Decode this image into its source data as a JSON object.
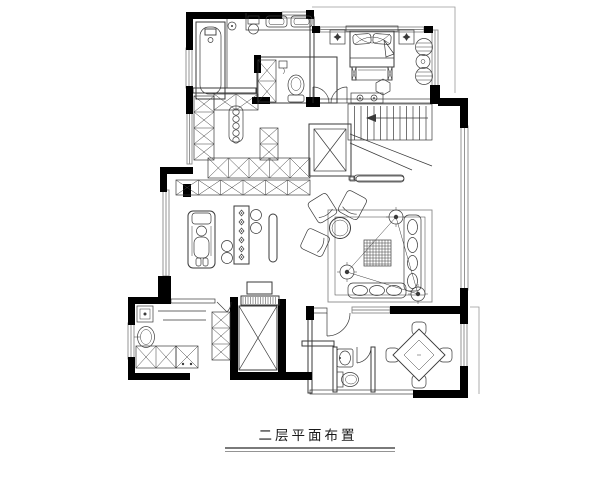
{
  "title": "二层平面布置",
  "drawing": {
    "type": "floor-plan",
    "floor_label": "二层平面布置",
    "orientation_note": "second-floor furniture layout plan"
  },
  "colors": {
    "walls": "#000000",
    "furniture_lines": "#3a3a3a",
    "window_lines": "#8a8a8a",
    "background": "#ffffff"
  },
  "rooms": {
    "master_bathroom": {
      "fixtures": [
        "bathtub",
        "double-basin-vanity",
        "pedestal-basin",
        "floor-drain"
      ]
    },
    "wc": {
      "fixtures": [
        "toilet",
        "storage-cabinet",
        "paper-holder",
        "swing-doors"
      ]
    },
    "master_bedroom": {
      "fixtures": [
        "double-bed",
        "nightstand-left",
        "nightstand-right",
        "bed-end-bench",
        "hexagonal-ottoman",
        "barrel-chair-upper",
        "barrel-chair-lower",
        "round-side-table",
        "dresser"
      ]
    },
    "walk_in_closet": {
      "fixtures": [
        "wardrobe-left-column",
        "wardrobe-top-run",
        "wardrobe-side-column",
        "wardrobe-bottom-row",
        "wardrobe-outer-row",
        "island-dresser"
      ]
    },
    "stair_hall": {
      "fixtures": [
        "staircase",
        "direction-arrow",
        "open-void",
        "railing"
      ]
    },
    "family_area": {
      "fixtures": [
        "recliner",
        "game-table",
        "stools",
        "slim-bench"
      ]
    },
    "lounge": {
      "fixtures": [
        "armchair-1",
        "armchair-2",
        "armchair-3",
        "round-tea-table",
        "area-rug",
        "hatched-rug-panel",
        "speaker-1",
        "speaker-2",
        "speaker-3",
        "chaise-sofa",
        "bottom-sofa",
        "media-console"
      ]
    },
    "study_nook": {
      "fixtures": [
        "computer-monitor",
        "keyboard-shelf"
      ]
    },
    "elevator_shaft": {
      "fixtures": [
        "shaft-x-marker"
      ]
    },
    "laundry": {
      "fixtures": [
        "washing-machine",
        "laundry-basin",
        "worktable",
        "base-cabinets",
        "tall-cabinet",
        "side-cabinets"
      ]
    },
    "guest_bathroom": {
      "fixtures": [
        "wash-basin",
        "toilet",
        "door"
      ]
    },
    "mahjong_room": {
      "fixtures": [
        "square-game-table",
        "chair-north",
        "chair-east",
        "chair-south",
        "chair-west"
      ]
    }
  }
}
